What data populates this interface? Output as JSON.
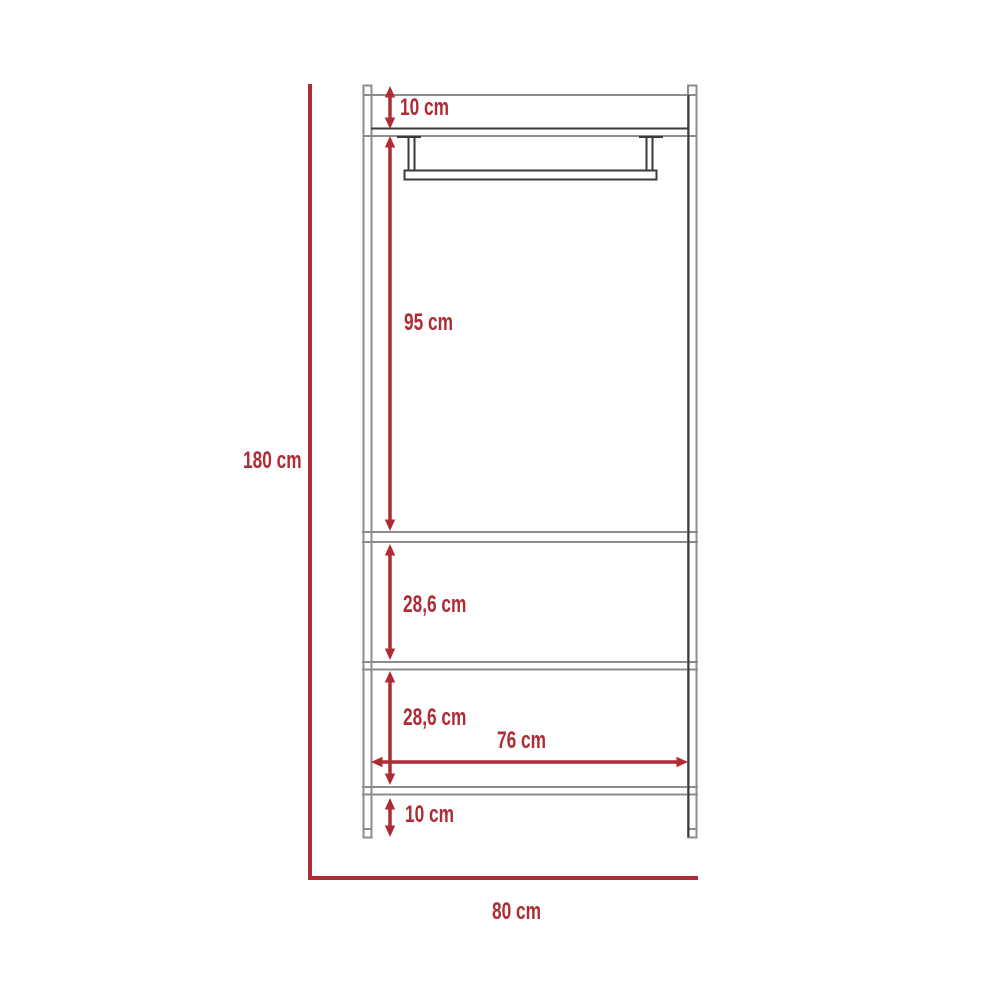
{
  "diagram": {
    "type": "furniture-dimension-drawing",
    "subject": "open wardrobe frame with hanging rod and shelves, front elevation",
    "unit": "cm",
    "colors": {
      "dimension_red": "#AF2B35",
      "frame_gray": "#8C8C8E",
      "frame_dark": "#3A3A3C",
      "background": "#FFFFFF"
    },
    "labels": {
      "total_height": "180 cm",
      "total_width": "80 cm",
      "top_panel_height": "10 cm",
      "hanging_space_height": "95 cm",
      "upper_shelf_gap": "28,6 cm",
      "lower_shelf_gap": "28,6 cm",
      "inner_width": "76 cm",
      "bottom_clearance": "10 cm"
    }
  }
}
